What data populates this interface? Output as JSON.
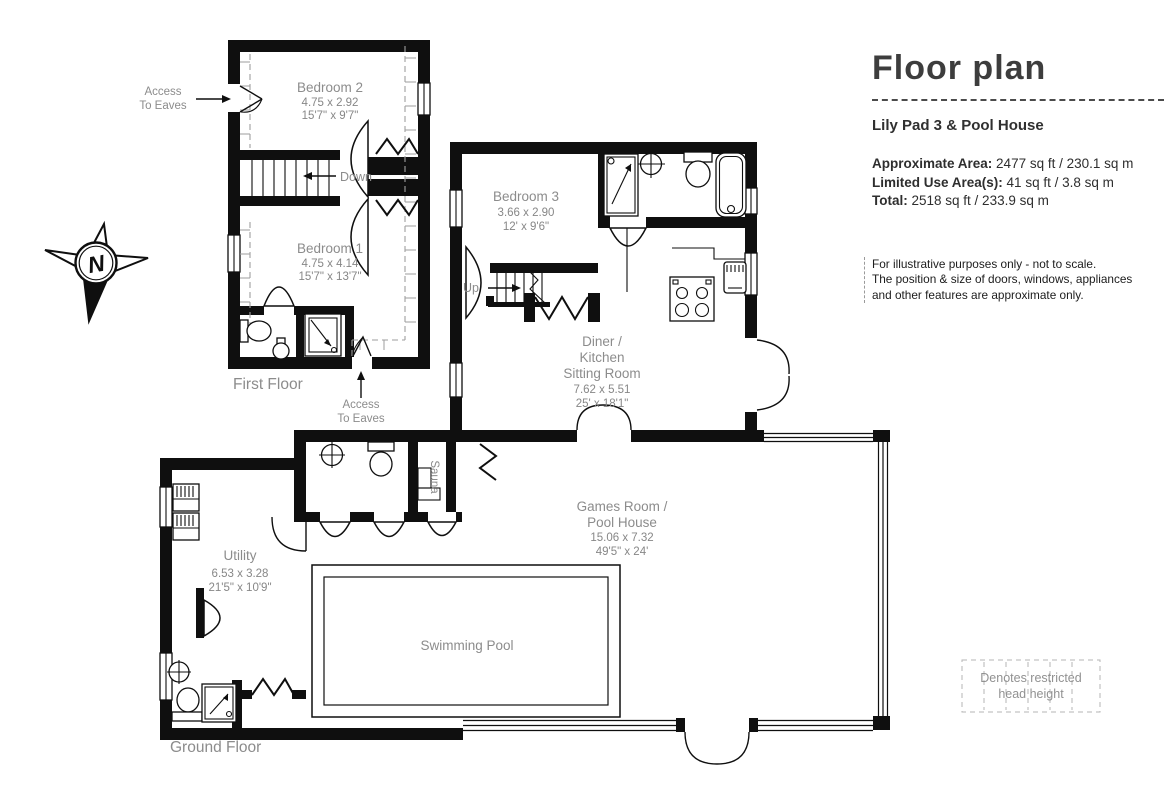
{
  "colors": {
    "wall": "#0f0f0f",
    "room_label": "#8c8c8c",
    "panel_text": "#313131",
    "legend_text": "#919191"
  },
  "panel": {
    "title": "Floor plan",
    "property_name": "Lily Pad 3 & Pool House",
    "areas": [
      {
        "label": "Approximate Area:",
        "value": "2477 sq ft / 230.1 sq m"
      },
      {
        "label": "Limited Use Area(s):",
        "value": "41 sq ft / 3.8 sq m"
      },
      {
        "label": "Total:",
        "value": "2518 sq ft / 233.9 sq m"
      }
    ],
    "disclaimer_line1": "For illustrative purposes only - not to scale.",
    "disclaimer_line2": "The position & size of doors, windows, appliances",
    "disclaimer_line3": "and other features are approximate only.",
    "legend": {
      "line1": "Denotes restricted",
      "line2": "head height"
    }
  },
  "floors": {
    "first": "First Floor",
    "ground": "Ground Floor"
  },
  "rooms": {
    "bedroom2": {
      "name": "Bedroom 2",
      "metric": "4.75 x 2.92",
      "imperial": "15'7\" x 9'7\""
    },
    "bedroom1": {
      "name": "Bedroom 1",
      "metric": "4.75 x 4.14",
      "imperial": "15'7\" x 13'7\""
    },
    "bedroom3": {
      "name": "Bedroom 3",
      "metric": "3.66 x 2.90",
      "imperial": "12' x 9'6\""
    },
    "diner": {
      "line1": "Diner /",
      "line2": "Kitchen",
      "line3": "Sitting Room",
      "metric": "7.62 x 5.51",
      "imperial": "25' x 18'1\""
    },
    "games": {
      "line1": "Games Room /",
      "line2": "Pool House",
      "metric": "15.06 x 7.32",
      "imperial": "49'5\" x 24'"
    },
    "utility": {
      "name": "Utility",
      "metric": "6.53 x 3.28",
      "imperial": "21'5\" x 10'9\""
    },
    "pool": {
      "name": "Swimming Pool"
    },
    "sauna": {
      "name": "Sauna"
    }
  },
  "annotations": {
    "down": "Down",
    "up": "Up",
    "access_line1": "Access",
    "access_line2": "To Eaves",
    "north": "N"
  }
}
